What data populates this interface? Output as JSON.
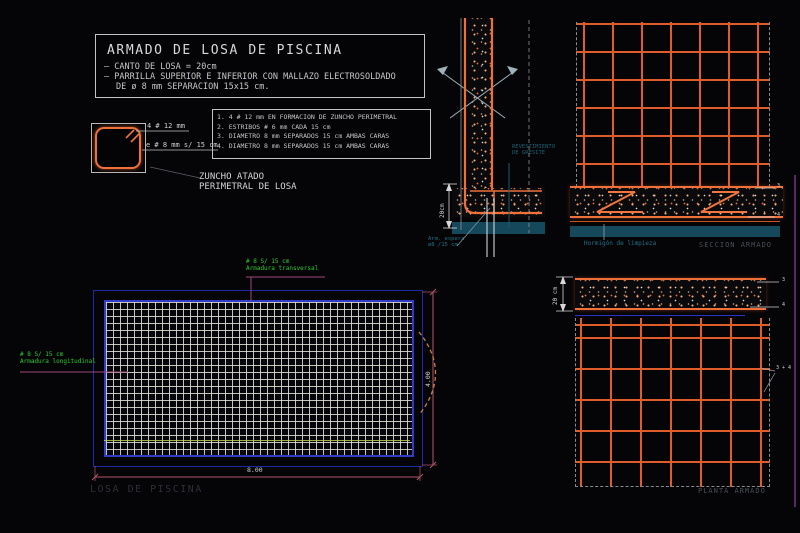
{
  "title_block": {
    "title": "ARMADO DE LOSA DE PISCINA",
    "line1": "– CANTO DE LOSA = 20cm",
    "line2": "– PARRILLA SUPERIOR E INFERIOR CON MALLAZO ELECTROSOLDADO",
    "line3": "DE ø 8 mm SEPARACION 15x15 cm."
  },
  "notes_block": {
    "items": [
      "1. 4 # 12 mm EN FORMACION DE ZUNCHO PERIMETRAL",
      "2. ESTRIBOS # 6 mm CADA 15 cm",
      "3. DIAMETRO 8 mm SEPARADOS 15 cm AMBAS CARAS",
      "4. DIAMETRO 8 mm SEPARADOS 15 cm AMBAS CARAS"
    ]
  },
  "stirrup_detail": {
    "label_bars": "4 # 12 mm",
    "label_stirrups": "e # 8 mm s/ 15 cm",
    "caption_line1": "ZUNCHO ATADO",
    "caption_line2": "PERIMETRAL DE LOSA"
  },
  "plan_view": {
    "transversal_label1": "# 8 S/ 15 cm",
    "transversal_label2": "Armadura transversal",
    "longitudinal_label1": "# 8 S/ 15 cm",
    "longitudinal_label2": "Armadura longitudinal",
    "dim_width": "8.00",
    "dim_height": "4.00",
    "caption": "LOSA DE PISCINA"
  },
  "wall_section": {
    "finish_label1": "REVESTIMIENTO",
    "finish_label2": "DE GRESITE",
    "dim_depth": "20cm",
    "dowel_label1": "Arm. espera",
    "dowel_label2": "ø8 /15 cm"
  },
  "section_view": {
    "callout_top": "3",
    "callout_bottom": "4",
    "lean_concrete_label": "Hormigón de limpieza",
    "caption": "SECCION ARMADO"
  },
  "planta_view": {
    "dim_depth": "20 cm",
    "callout_top": "3",
    "callout_bottom": "4",
    "callout_grid": "3 + 4",
    "caption": "PLANTA ARMADO"
  },
  "colors": {
    "rebar_orange": "#f0703a",
    "mesh_blue": "#2e3cc8",
    "dim_magenta": "#b4566a",
    "leader_purple": "#9a4677",
    "annotation_green": "#2ecc2e",
    "annotation_cyan": "#237084",
    "lean_concrete_teal": "#16485c"
  }
}
